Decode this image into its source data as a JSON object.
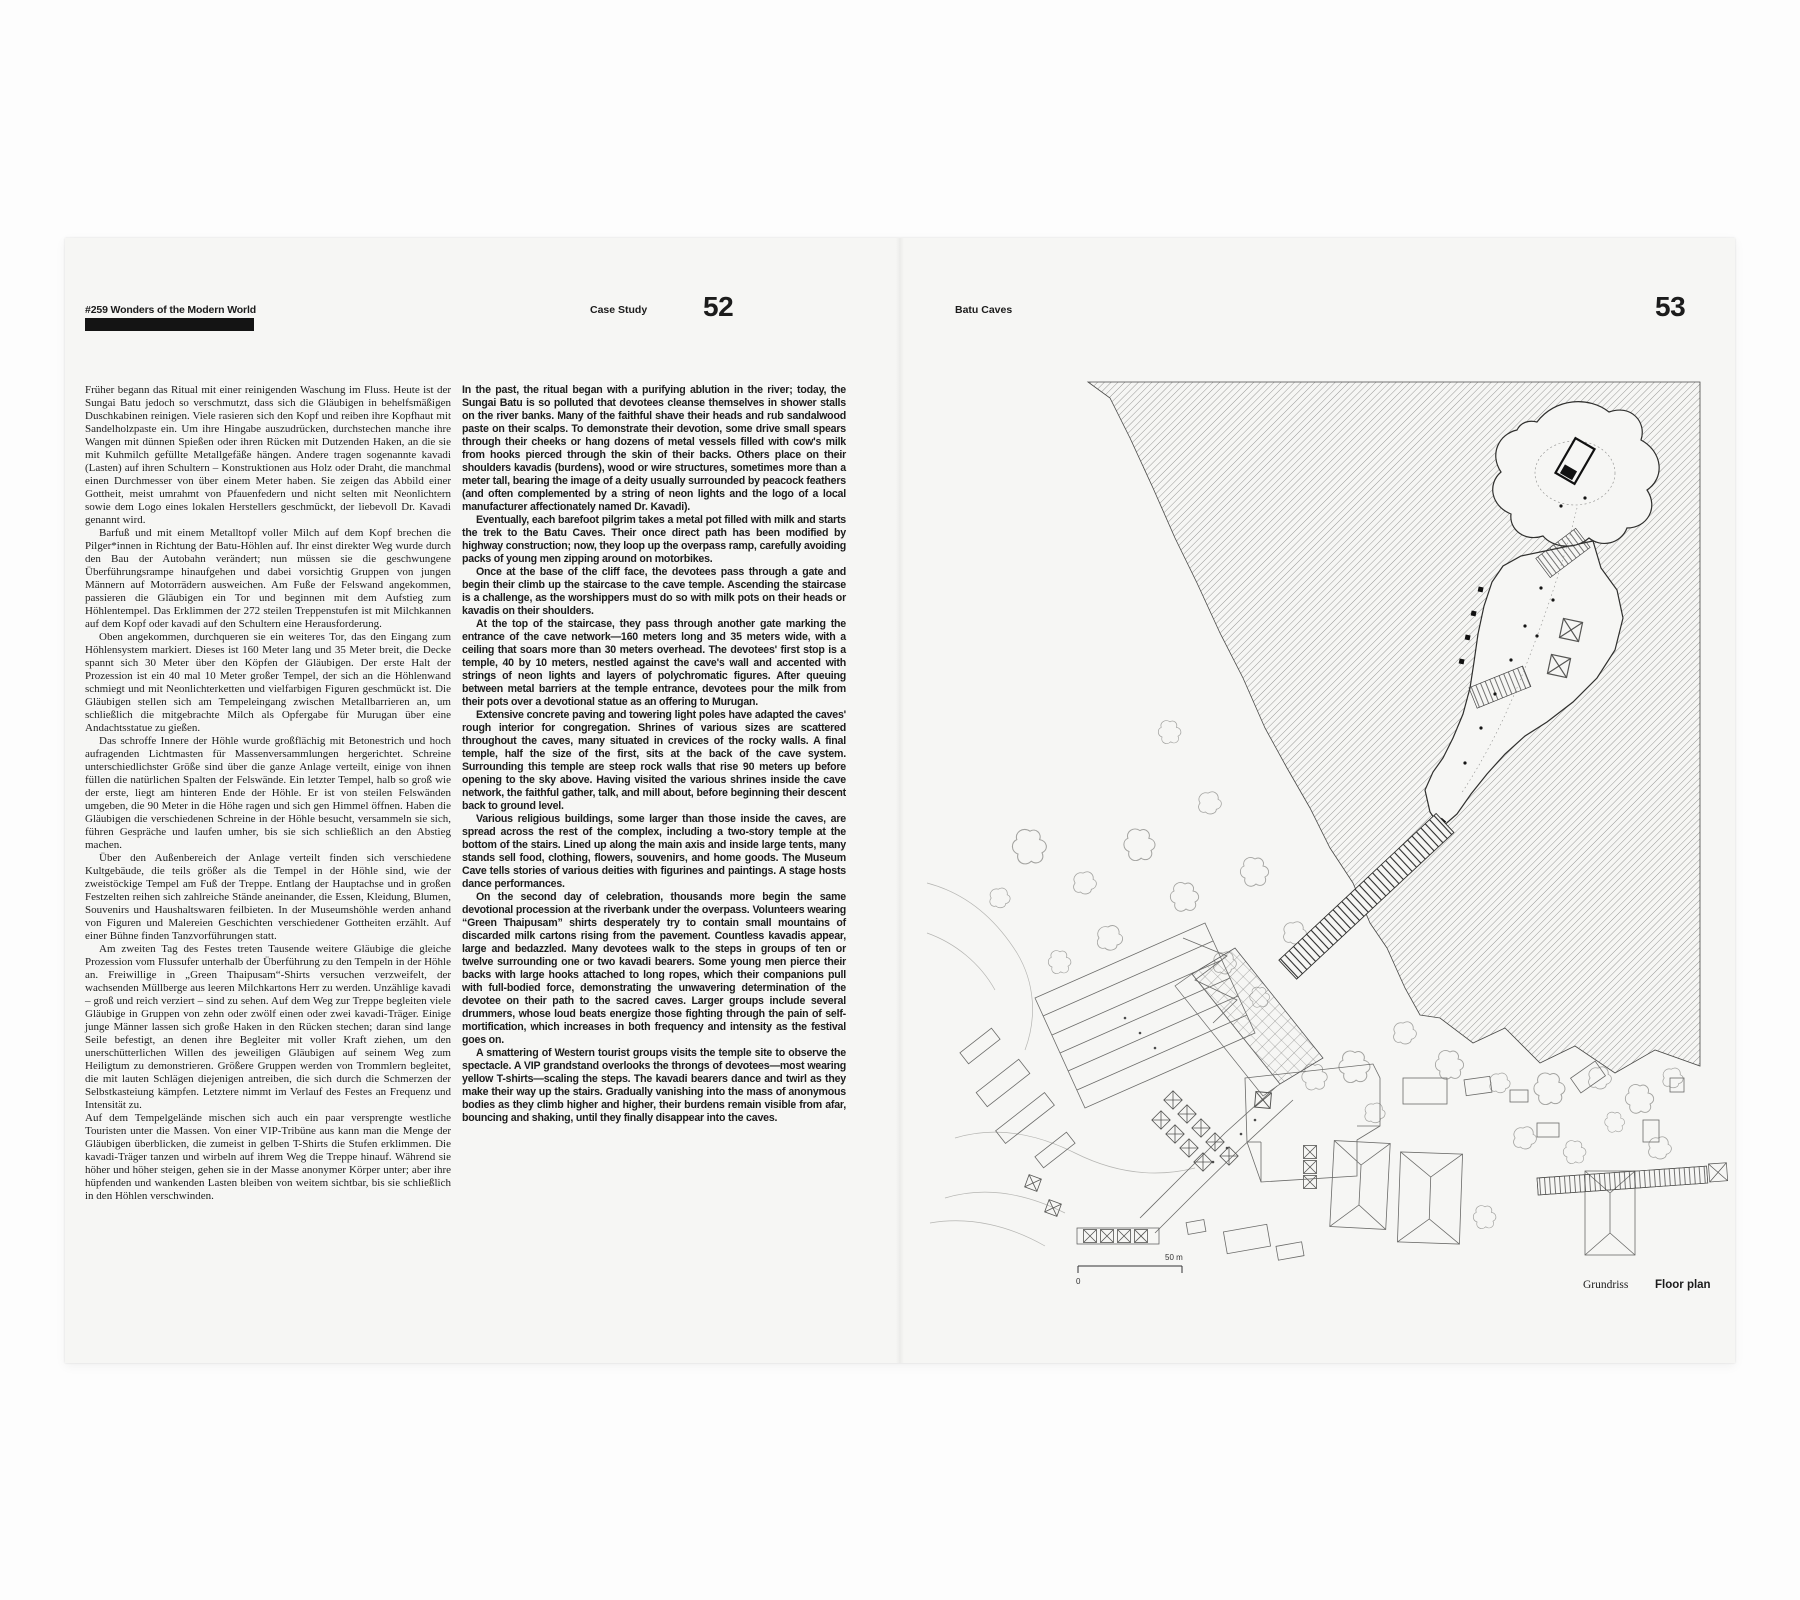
{
  "page_left": {
    "series_title": "#259 Wonders of the Modern World",
    "section_label": "Case Study",
    "page_number": "52",
    "german_paragraphs": [
      "Früher begann das Ritual mit einer reinigenden Waschung im Fluss. Heute ist der Sungai Batu jedoch so verschmutzt, dass sich die Gläubigen in behelfsmäßigen Duschkabinen reinigen. Viele rasieren sich den Kopf und reiben ihre Kopfhaut mit Sandelholzpaste ein. Um ihre Hingabe auszudrücken, durchstechen manche ihre Wangen mit dünnen Spießen oder ihren Rücken mit Dutzenden Haken, an die sie mit Kuhmilch gefüllte Metallgefäße hängen. Andere tragen sogenannte kavadi (Lasten) auf ihren Schultern – Konstruktionen aus Holz oder Draht, die manchmal einen Durchmesser von über einem Meter haben. Sie zeigen das Abbild einer Gottheit, meist umrahmt von Pfauenfedern und nicht selten mit Neonlichtern sowie dem Logo eines lokalen Herstellers geschmückt, der liebevoll Dr. Kavadi genannt wird.",
      "Barfuß und mit einem Metalltopf voller Milch auf dem Kopf brechen die Pilger*innen in Richtung der Batu-Höhlen auf. Ihr einst direkter Weg wurde durch den Bau der Autobahn verändert; nun müssen sie die geschwungene Überführungsrampe hinaufgehen und dabei vorsichtig Gruppen von jungen Männern auf Motorrädern ausweichen. Am Fuße der Felswand angekommen, passieren die Gläubigen ein Tor und beginnen mit dem Aufstieg zum Höhlentempel. Das Erklimmen der 272 steilen Treppenstufen ist mit Milchkannen auf dem Kopf oder kavadi auf den Schultern eine Herausforderung.",
      "Oben angekommen, durchqueren sie ein weiteres Tor, das den Eingang zum Höhlensystem markiert. Dieses ist 160 Meter lang und 35 Meter breit, die Decke spannt sich 30 Meter über den Köpfen der Gläubigen. Der erste Halt der Prozession ist ein 40 mal 10 Meter großer Tempel, der sich an die Höhlenwand schmiegt und mit Neonlichterketten und vielfarbigen Figuren geschmückt ist. Die Gläubigen stellen sich am Tempeleingang zwischen Metallbarrieren an, um schließlich die mitgebrachte Milch als Opfergabe für Murugan über eine Andachtsstatue zu gießen.",
      "Das schroffe Innere der Höhle wurde großflächig mit Betonestrich und hoch aufragenden Lichtmasten für Massenversammlungen hergerichtet. Schreine unterschiedlichster Größe sind über die ganze Anlage verteilt, einige von ihnen füllen die natürlichen Spalten der Felswände. Ein letzter Tempel, halb so groß wie der erste, liegt am hinteren Ende der Höhle. Er ist von steilen Felswänden umgeben, die 90 Meter in die Höhe ragen und sich gen Himmel öffnen. Haben die Gläubigen die verschiedenen Schreine in der Höhle besucht, versammeln sie sich, führen Gespräche und laufen umher, bis sie sich schließlich an den Abstieg machen.",
      "Über den Außenbereich der Anlage verteilt finden sich verschiedene Kultgebäude, die teils größer als die Tempel in der Höhle sind, wie der zweistöckige Tempel am Fuß der Treppe. Entlang der Hauptachse und in großen Festzelten reihen sich zahlreiche Stände aneinander, die Essen, Kleidung, Blumen, Souvenirs und Haushaltswaren feilbieten. In der Museumshöhle werden anhand von Figuren und Malereien Geschichten verschiedener Gottheiten erzählt. Auf einer Bühne finden Tanzvorführungen statt.",
      "Am zweiten Tag des Festes treten Tausende weitere Gläubige die gleiche Prozession vom Flussufer unterhalb der Überführung zu den Tempeln in der Höhle an. Freiwillige in „Green Thaipusam“-Shirts versuchen verzweifelt, der wachsenden Müllberge aus leeren Milchkartons Herr zu werden. Unzählige kavadi – groß und reich verziert – sind zu sehen. Auf dem Weg zur Treppe begleiten viele Gläubige in Gruppen von zehn oder zwölf einen oder zwei kavadi-Träger. Einige junge Männer lassen sich große Haken in den Rücken stechen; daran sind lange Seile befestigt, an denen ihre Begleiter mit voller Kraft ziehen, um den unerschütterlichen Willen des jeweiligen Gläubigen auf seinem Weg zum Heiligtum zu demonstrieren. Größere Gruppen werden von Trommlern begleitet, die mit lauten Schlägen diejenigen antreiben, die sich durch die Schmerzen der Selbstkasteiung kämpfen. Letztere nimmt im Verlauf des Festes an Frequenz und Intensität zu.",
      "Auf dem Tempelgelände mischen sich auch ein paar versprengte westliche Touristen unter die Massen. Von einer VIP-Tribüne aus kann man die Menge der Gläubigen überblicken, die zumeist in gelben T-Shirts die Stufen erklimmen. Die kavadi-Träger tanzen und wirbeln auf ihrem Weg die Treppe hinauf. Während sie höher und höher steigen, gehen sie in der Masse anonymer Körper unter; aber ihre hüpfenden und wankenden Lasten bleiben von weitem sichtbar, bis sie schließlich in den Höhlen verschwinden."
    ],
    "english_paragraphs": [
      "In the past, the ritual began with a purifying ablution in the river; today, the Sungai Batu is so polluted that devotees cleanse themselves in shower stalls on the river banks. Many of the faithful shave their heads and rub sandalwood paste on their scalps. To demonstrate their devotion, some drive small spears through their cheeks or hang dozens of metal vessels filled with cow's milk from hooks pierced through the skin of their backs. Others place on their shoulders kavadis (burdens), wood or wire structures, sometimes more than a meter tall, bearing the image of a deity usually surrounded by peacock feathers (and often complemented by a string of neon lights and the logo of a local manufacturer affectionately named Dr. Kavadi).",
      "Eventually, each barefoot pilgrim takes a metal pot filled with milk and starts the trek to the Batu Caves. Their once direct path has been modified by highway construction; now, they loop up the overpass ramp, carefully avoiding packs of young men zipping around on motorbikes.",
      "Once at the base of the cliff face, the devotees pass through a gate and begin their climb up the staircase to the cave temple. Ascending the staircase is a challenge, as the worshippers must do so with milk pots on their heads or kavadis on their shoulders.",
      "At the top of the staircase, they pass through another gate marking the entrance of the cave network—160 meters long and 35 meters wide, with a ceiling that soars more than 30 meters overhead. The devotees' first stop is a temple, 40 by 10 meters, nestled against the cave's wall and accented with strings of neon lights and layers of polychromatic figures. After queuing between metal barriers at the temple entrance, devotees pour the milk from their pots over a devotional statue as an offering to Murugan.",
      "Extensive concrete paving and towering light poles have adapted the caves' rough interior for congregation. Shrines of various sizes are scattered throughout the caves, many situated in crevices of the rocky walls. A final temple, half the size of the first, sits at the back of the cave system. Surrounding this temple are steep rock walls that rise 90 meters up before opening to the sky above. Having visited the various shrines inside the cave network, the faithful gather, talk, and mill about, before beginning their descent back to ground level.",
      "Various religious buildings, some larger than those inside the caves, are spread across the rest of the complex, including a two-story temple at the bottom of the stairs. Lined up along the main axis and inside large tents, many stands sell food, clothing, flowers, souvenirs, and home goods. The Museum Cave tells stories of various deities with figurines and paintings. A stage hosts dance performances.",
      "On the second day of celebration, thousands more begin the same devotional procession at the riverbank under the overpass. Volunteers wearing “Green Thaipusam” shirts desperately try to contain small mountains of discarded milk cartons rising from the pavement. Countless kavadis appear, large and bedazzled. Many devotees walk to the steps in groups of ten or twelve surrounding one or two kavadi bearers. Some young men pierce their backs with large hooks attached to long ropes, which their companions pull with full-bodied force, demonstrating the unwavering determination of the devotee on their path to the sacred caves. Larger groups include several drummers, whose loud beats energize those fighting through the pain of self-mortification, which increases in both frequency and intensity as the festival goes on.",
      "A smattering of Western tourist groups visits the temple site to observe the spectacle. A VIP grandstand overlooks the throngs of devotees—most wearing yellow T-shirts—scaling the steps. The kavadi bearers dance and twirl as they make their way up the stairs. Gradually vanishing into the mass of anonymous bodies as they climb higher and higher, their burdens remain visible from afar, bouncing and shaking, until they finally disappear into the caves."
    ]
  },
  "page_right": {
    "header_label": "Batu Caves",
    "page_number": "53",
    "scale": {
      "zero": "0",
      "fifty": "50 m"
    },
    "caption_de": "Grundriss",
    "caption_en": "Floor plan"
  }
}
